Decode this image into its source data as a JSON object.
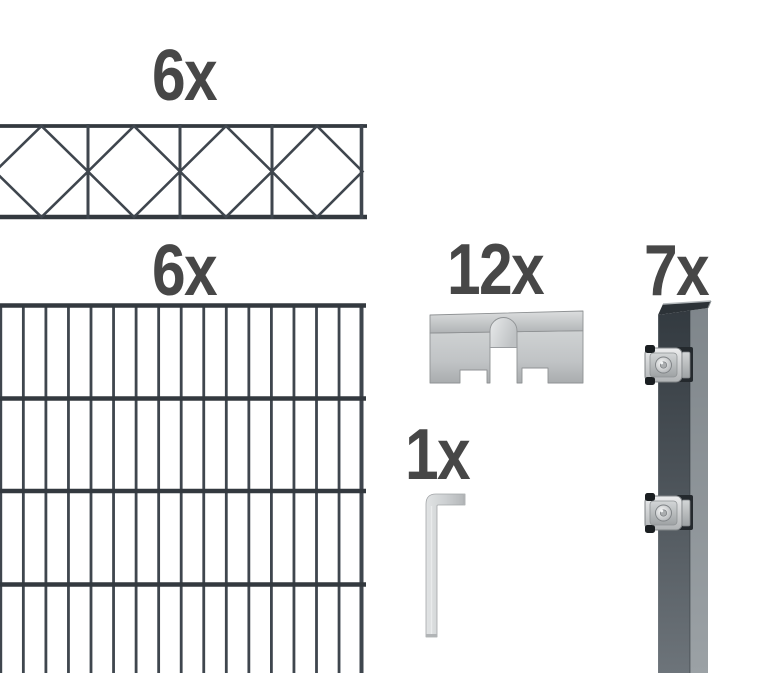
{
  "kit": {
    "parts": {
      "decor_panel": {
        "count": "6x",
        "icon": "diamond-lattice-topper-panel-icon"
      },
      "mesh_panel": {
        "count": "6x",
        "icon": "double-rod-mesh-panel-icon"
      },
      "flat_bar_bracket": {
        "count": "12x",
        "icon": "flat-bar-cover-bracket-icon"
      },
      "allen_key": {
        "count": "1x",
        "icon": "hex-allen-key-icon"
      },
      "post": {
        "count": "7x",
        "icon": "anthracite-post-with-clamps-icon"
      }
    }
  },
  "colors": {
    "background": "#ffffff",
    "label_text": "#474747",
    "mesh_wire": "#3f464e",
    "mesh_rail": "#33393f",
    "post_front_top": "#333a40",
    "post_front_bottom": "#6d747a",
    "post_side_top": "#7f868b",
    "post_side_bottom": "#9ba1a5",
    "metal_light": "#ecedee",
    "metal_mid": "#c6c9cb",
    "metal_dark": "#9fa2a5",
    "clamp_black": "#1a1e21"
  }
}
